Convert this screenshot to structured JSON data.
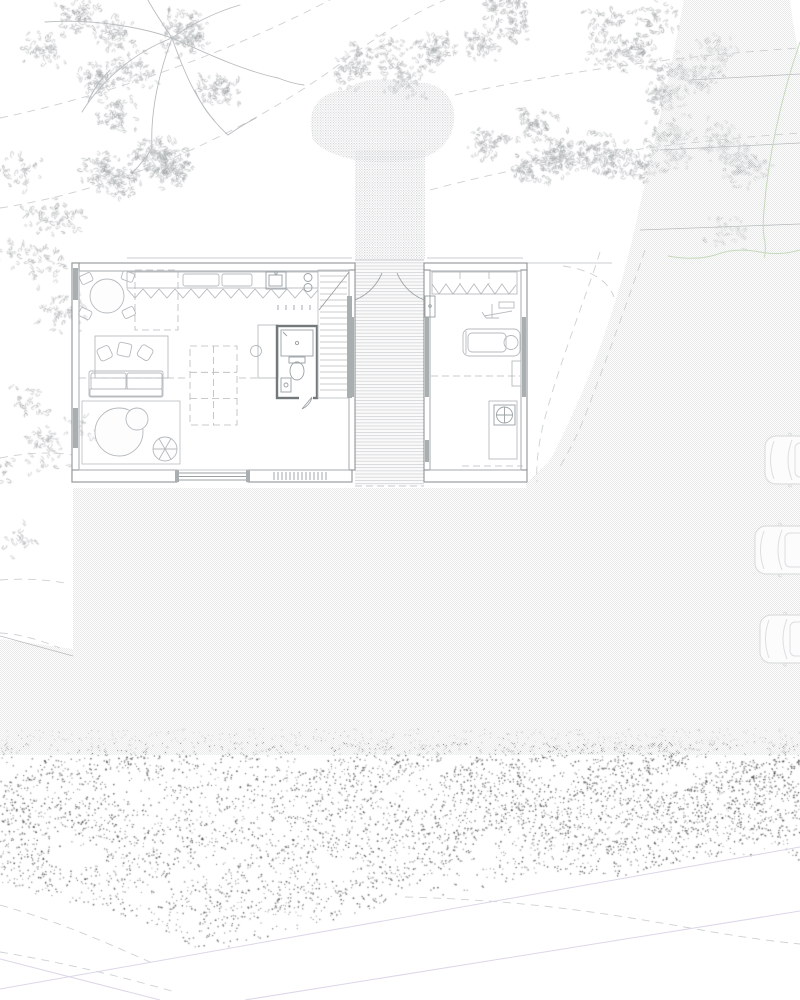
{
  "document": {
    "kind": "architectural-site-plan",
    "description": "ground-floor plan of a two-wing house on a wooded site with road, parked cars and scrub vegetation",
    "visible_text": []
  },
  "palette": {
    "paper": "#ffffff",
    "lineLight": "#b9bdbf",
    "lineMid": "#9aa0a3",
    "wallEdge": "#8f9497",
    "frameFill": "#a9aeb0",
    "furn": "#b6babd",
    "bathWall": "#73787b",
    "lawnDot": "#e7e8e8",
    "gravelDot": "#c9cbcd",
    "plank": "#d2d5d6",
    "contour": "#cdd1d2",
    "scrubDot": "#3d3d3d",
    "leaf": "#aeb2b4",
    "leafDark": "#8d9193",
    "purple": "#ddd6e7",
    "green": "#c6d9ba",
    "carLine": "#dcdedf"
  },
  "site": {
    "trees": 2,
    "contour_lines": "dashed",
    "road": "textured band curving along right side, merges with rear lawn",
    "gravel_path": "landing blob + straight strip leading to breezeway",
    "scrub_band": "dense dark stipple across lower part",
    "cars": [
      {
        "x": 765,
        "y": 460
      },
      {
        "x": 755,
        "y": 550
      },
      {
        "x": 760,
        "y": 639
      }
    ]
  },
  "building": {
    "left_wing": {
      "rooms": [
        "kitchen-dining-living",
        "bathroom",
        "stair"
      ],
      "furniture": [
        "dining-table-4-chairs",
        "kitchen-counter-sink-cooktop",
        "rug-with-cushions",
        "sofa",
        "round-rug",
        "coffee-table",
        "spoke-table",
        "desk-with-stool",
        "shower",
        "toilet",
        "wash-basin",
        "staircase"
      ]
    },
    "right_wing": {
      "rooms": [
        "studio-gym"
      ],
      "furniture": [
        "wardrobe",
        "exercise-machine",
        "treadmill",
        "side-table",
        "equipment-desk",
        "fan-unit"
      ]
    },
    "breezeway": "boardwalk deck with two entry doors"
  },
  "textures": {
    "scrub_band": {
      "top": 742,
      "bottom_edge": [
        [
          0,
          885
        ],
        [
          60,
          900
        ],
        [
          110,
          912
        ],
        [
          160,
          930
        ],
        [
          205,
          952
        ],
        [
          255,
          940
        ],
        [
          330,
          920
        ],
        [
          400,
          901
        ],
        [
          470,
          890
        ],
        [
          540,
          872
        ],
        [
          620,
          876
        ],
        [
          700,
          856
        ],
        [
          760,
          858
        ],
        [
          800,
          860
        ]
      ],
      "count": 5200
    },
    "tree_canopies": [
      {
        "cx": 120,
        "cy": 90,
        "rx": 140,
        "ry": 100,
        "count": 850,
        "clusters": 14
      },
      {
        "cx": 30,
        "cy": 255,
        "rx": 55,
        "ry": 115,
        "count": 200,
        "clusters": 7
      },
      {
        "cx": 45,
        "cy": 470,
        "rx": 55,
        "ry": 85,
        "count": 130,
        "clusters": 6
      },
      {
        "cx": 545,
        "cy": 80,
        "rx": 125,
        "ry": 95,
        "count": 800,
        "clusters": 13
      },
      {
        "cx": 655,
        "cy": 85,
        "rx": 70,
        "ry": 90,
        "count": 420,
        "clusters": 9
      },
      {
        "cx": 725,
        "cy": 175,
        "rx": 45,
        "ry": 75,
        "count": 200,
        "clusters": 6
      },
      {
        "cx": 362,
        "cy": 70,
        "rx": 45,
        "ry": 32,
        "count": 170,
        "clusters": 5
      }
    ]
  }
}
